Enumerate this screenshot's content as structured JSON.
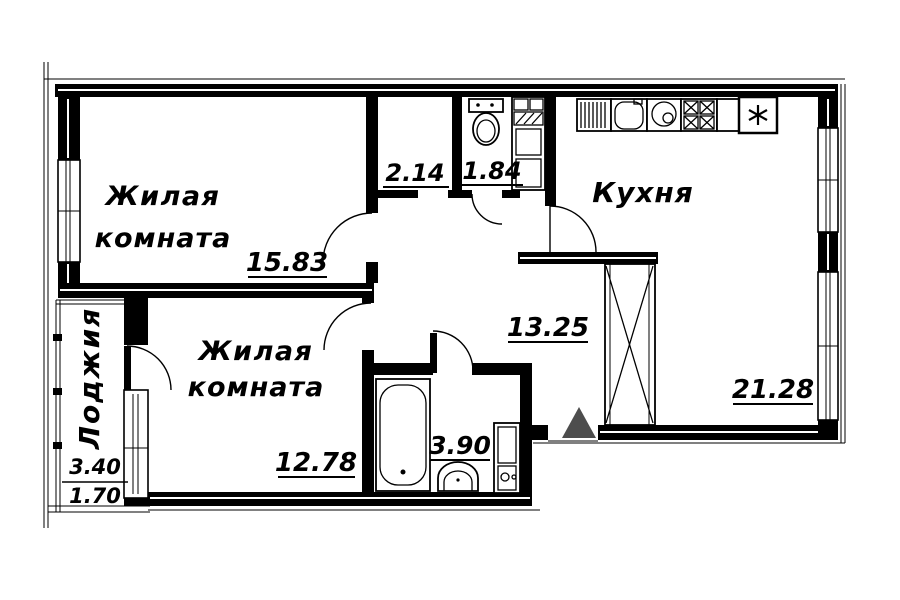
{
  "plan_title": "apartment-floor-plan",
  "rooms": {
    "living1": {
      "name1": "Жилая",
      "name2": "комната",
      "area": "15.83"
    },
    "living2": {
      "name1": "Жилая",
      "name2": "комната",
      "area": "12.78"
    },
    "kitchen": {
      "name": "Кухня",
      "area": "21.28"
    },
    "hall": {
      "area": "13.25"
    },
    "wardrobe": {
      "area": "2.14"
    },
    "wc": {
      "area": "1.84"
    },
    "bathroom": {
      "area": "3.90"
    },
    "loggia": {
      "name": "Лоджия",
      "area_total": "3.40",
      "area_reduced": "1.70"
    }
  },
  "colors": {
    "wall": "#000000",
    "background": "#ffffff",
    "entrance_marker": "#4d4d4d"
  },
  "icons": [
    "toilet-icon",
    "bathtub-icon",
    "bath-sink-icon",
    "washing-machine-icon",
    "kitchen-drainboard-icon",
    "kitchen-sink-icon",
    "dishwasher-icon",
    "stove-icon",
    "refrigerator-icon",
    "ventilation-shaft-icon",
    "entrance-triangle-icon"
  ]
}
